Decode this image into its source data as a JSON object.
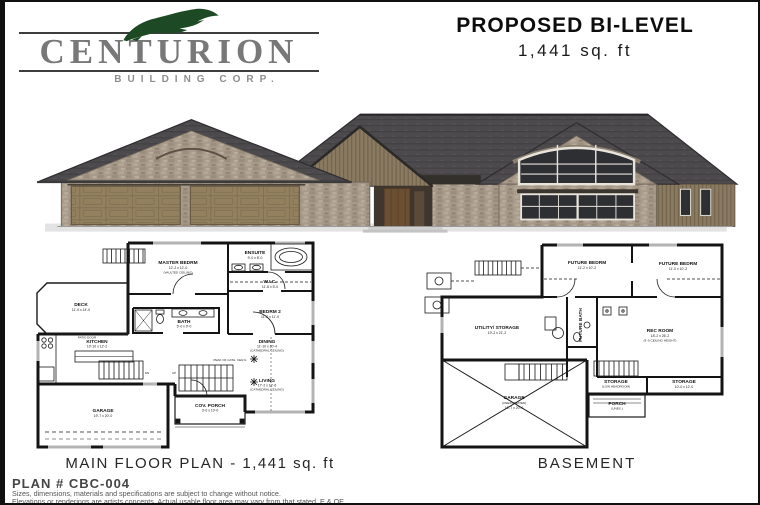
{
  "logo": {
    "company": "CENTURION",
    "tagline": "BUILDING CORP.",
    "icon": "centurion-plume-icon",
    "brand_green": "#1d4a24",
    "text_gray": "#787878"
  },
  "header": {
    "title": "PROPOSED BI-LEVEL",
    "area": "1,441 sq. ft"
  },
  "rendering": {
    "description": "front elevation rendering of stone bi-level home with triple garage",
    "roof_color": "#4c4a4c",
    "stone_color": "#a79a8a",
    "siding_color": "#8a7a62",
    "garage_door_color": "#93805f"
  },
  "main_floor": {
    "caption": "MAIN FLOOR PLAN - 1,441 sq. ft",
    "rooms": [
      {
        "name": "MASTER BEDRM",
        "dims": "12'-2 x 12'-0",
        "note": "(VAULTED CEILING)"
      },
      {
        "name": "ENSUITE",
        "dims": "9'-0 x 8'-0"
      },
      {
        "name": "W.I.C.",
        "dims": "11'-8 x 5'-0"
      },
      {
        "name": "BEDRM 2",
        "dims": "11'-2 x 11'-0"
      },
      {
        "name": "DECK",
        "dims": "11'-0 x 14'-0"
      },
      {
        "name": "BATH",
        "dims": "5'-0 x 9'-0"
      },
      {
        "name": "KITCHEN",
        "dims": "10'-10 x 12'-2"
      },
      {
        "name": "DINING",
        "dims": "11'-10 x 10'-4",
        "note": "(CATHEDRAL CEILING)"
      },
      {
        "name": "LIVING",
        "dims": "17'-2 x 12'-6",
        "note": "(CATHEDRAL CEILING)"
      },
      {
        "name": "GARAGE",
        "dims": "19'-7 x 20'-0"
      },
      {
        "name": "COV. PORCH",
        "dims": "3'-0 x 10'-0"
      }
    ],
    "annotations": {
      "patio_door": "PATIO DOOR",
      "peak": "PEAK OF CATH. CEIL'G",
      "dn": "DN",
      "up": "UP"
    }
  },
  "basement": {
    "caption": "BASEMENT",
    "rooms": [
      {
        "name": "FUTURE BEDRM",
        "dims": "11'-2 x 10'-2"
      },
      {
        "name": "FUTURE BEDRM",
        "dims": "11'-0 x 10'-2"
      },
      {
        "name": "REC ROOM",
        "dims": "18'-2 x 26'-2",
        "note": "(9'-0 CEILING HEIGHT)"
      },
      {
        "name": "UTILITY/ STORAGE",
        "dims": "19'-2 x 21'-2"
      },
      {
        "name": "FUTURE BATH"
      },
      {
        "name": "GARAGE",
        "note": "(UNEXCAVATED)",
        "dims": "19'-7 x 20'-0"
      },
      {
        "name": "STORAGE",
        "note": "(LOW HEADROOM)"
      },
      {
        "name": "PORCH",
        "note": "(UNEX.)"
      },
      {
        "name": "STORAGE",
        "dims": "10'-0 x 12'-0"
      }
    ]
  },
  "footer": {
    "plan_number": "PLAN # CBC-004",
    "disclaimer_line1": "Sizes, dimensions, materials and specifications are subject to change without notice.",
    "disclaimer_line2": "Elevations or renderings are artists concepts. Actual usable floor area may vary from that stated. E & OE."
  }
}
